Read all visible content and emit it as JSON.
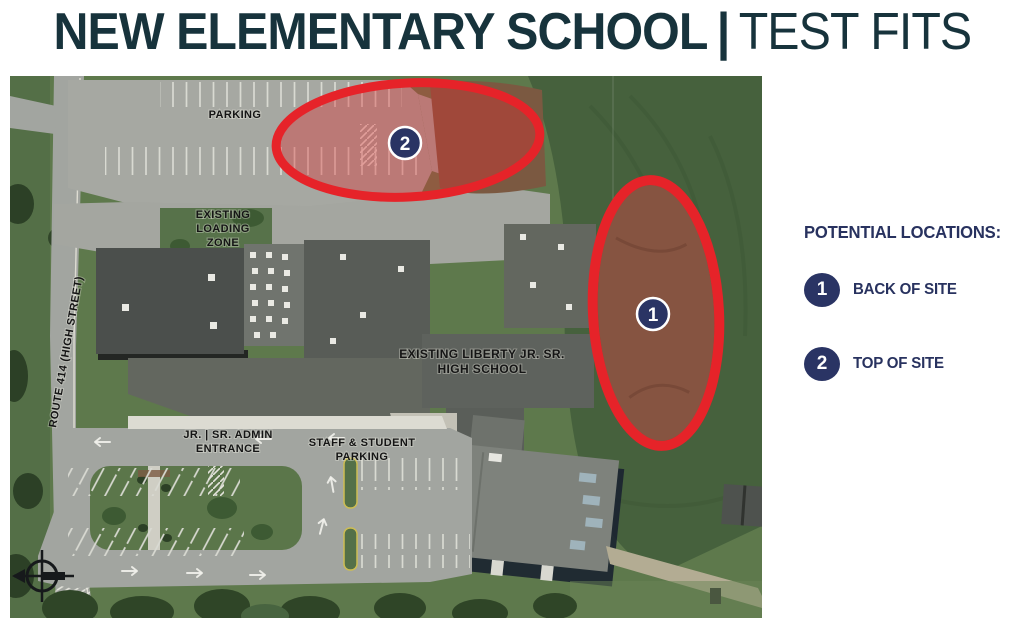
{
  "title": {
    "main": "NEW ELEMENTARY SCHOOL",
    "separator": "|",
    "sub": "TEST FITS"
  },
  "legend": {
    "heading": "POTENTIAL LOCATIONS:",
    "items": [
      {
        "badge": "1",
        "label": "BACK OF SITE"
      },
      {
        "badge": "2",
        "label": "TOP OF SITE"
      }
    ]
  },
  "map": {
    "type": "aerial-site-plan",
    "labels": {
      "parking": "PARKING",
      "loading_zone": [
        "EXISTING",
        "LOADING",
        "ZONE"
      ],
      "route": "ROUTE 414 (HIGH STREET)",
      "school": [
        "EXISTING LIBERTY JR. SR.",
        "HIGH SCHOOL"
      ],
      "admin_entrance": [
        "JR. | SR. ADMIN",
        "ENTRANCE"
      ],
      "staff_parking": [
        "STAFF & STUDENT",
        "PARKING"
      ]
    },
    "markers": [
      {
        "number": "1"
      },
      {
        "number": "2"
      }
    ]
  },
  "colors": {
    "title": "#17333c",
    "legend_navy": "#28325f",
    "badge_navy": "#2a3464",
    "accent_red": "#e62329",
    "overlay_red": "rgba(221,44,48,0.38)",
    "grass": "#5e794c",
    "dark_field": "#46613d",
    "pavement": "#a5a7a1",
    "roof_dark": "#4b4f4c",
    "dirt": "#7c5a43"
  }
}
